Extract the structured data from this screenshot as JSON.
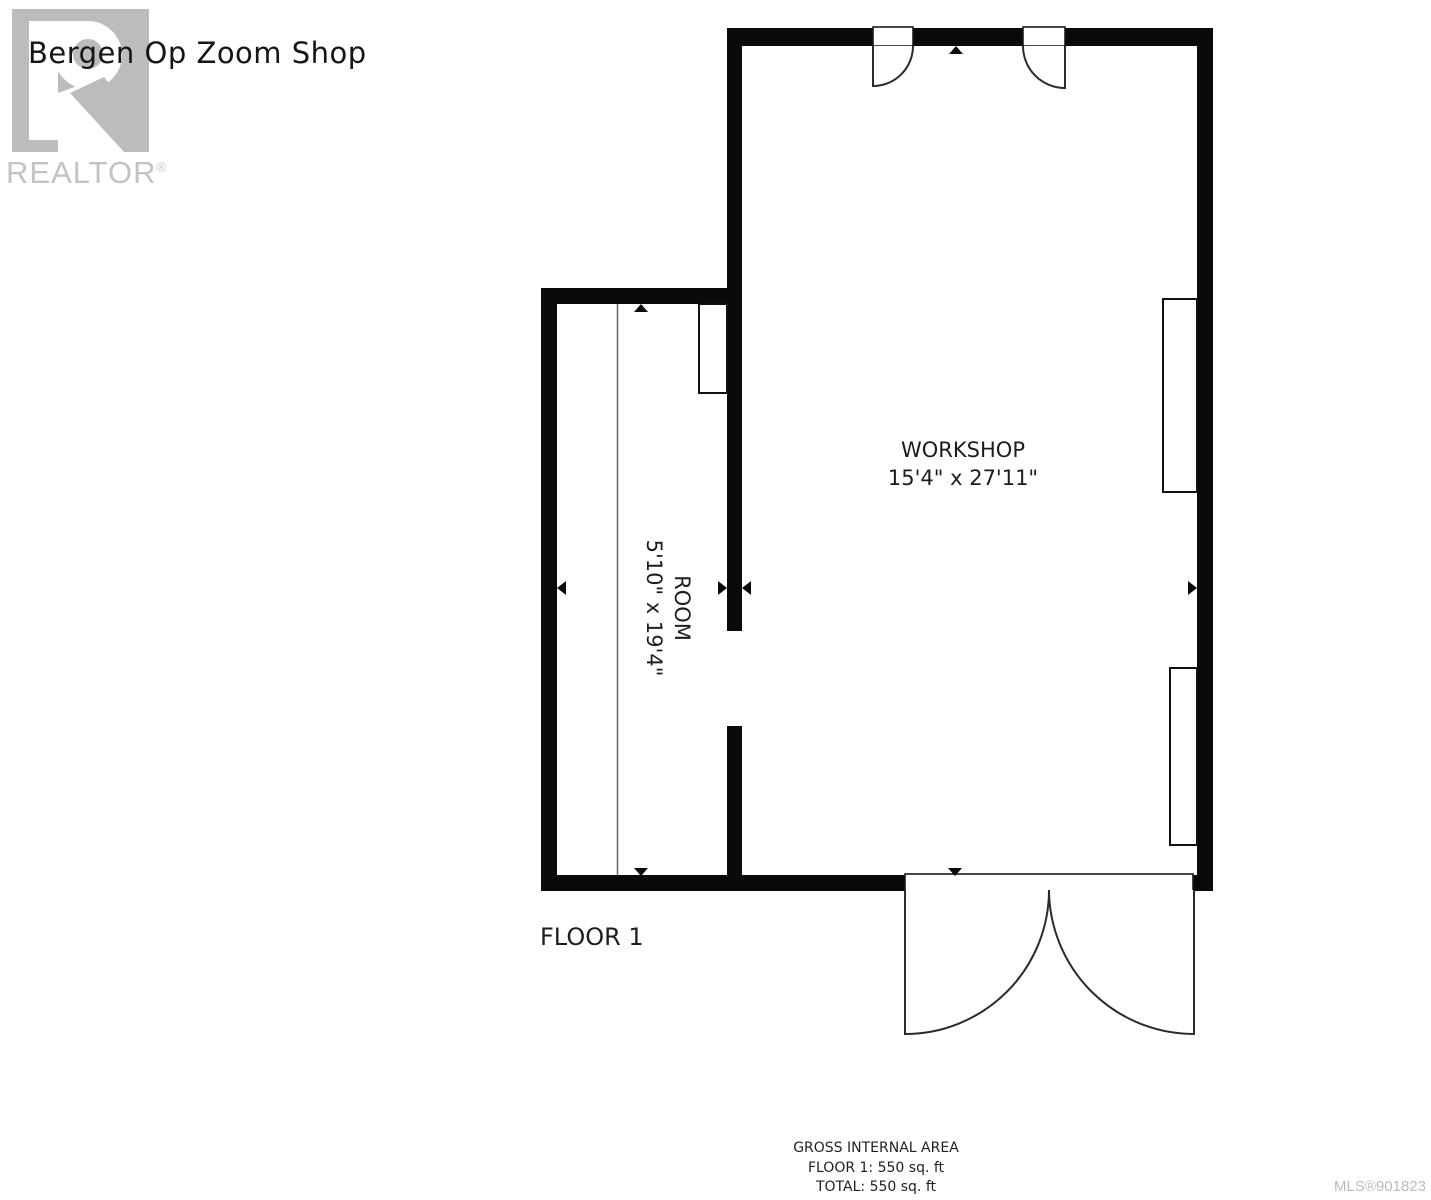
{
  "header": {
    "title": "Bergen Op Zoom Shop"
  },
  "watermark": {
    "brand": "REALTOR",
    "registered": "®"
  },
  "plan": {
    "floor_label": "FLOOR 1",
    "rooms": [
      {
        "name": "WORKSHOP",
        "dimensions": "15'4\" x 27'11\""
      },
      {
        "name": "ROOM",
        "dimensions": "5'10\" x 19'4\""
      }
    ]
  },
  "footer": {
    "area_title": "GROSS INTERNAL AREA",
    "floor_area": "FLOOR 1: 550 sq. ft",
    "total_area": "TOTAL: 550 sq. ft",
    "mls": "MLS®901823"
  },
  "colors": {
    "wall": "#0a0a0a",
    "label_text": "#1d1d1d",
    "watermark_gray": "#bcbcbc",
    "mls_gray": "#b9bcbe"
  }
}
